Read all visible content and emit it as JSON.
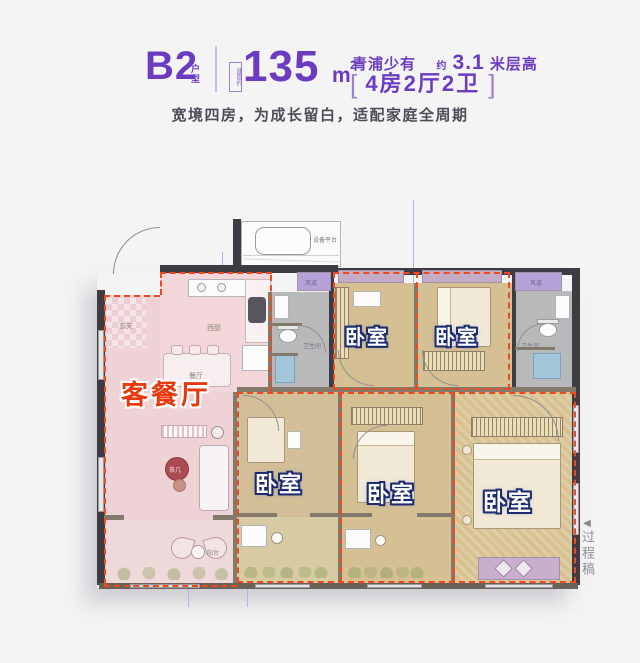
{
  "header": {
    "code": "B2",
    "code_suffix": "户型",
    "area_prefix": "建面约",
    "area_number": "135",
    "area_unit": "m",
    "area_sup": "2",
    "tagline_location": "青浦少有",
    "tagline_approx": "约",
    "tagline_height": "3.1",
    "tagline_height_unit": "米层高",
    "bracket_open": "[",
    "bracket_close": "]",
    "layout_spec": "4房2厅2卫",
    "subtitle": "宽境四房，为成长留白，适配家庭全周期",
    "accent_color": "#6b3cc0"
  },
  "plan": {
    "rooms": [
      {
        "name": "living-dining",
        "label": "客餐厅"
      },
      {
        "name": "bedroom-top-1",
        "label": "卧室"
      },
      {
        "name": "bedroom-top-2",
        "label": "卧室"
      },
      {
        "name": "bedroom-bottom-1",
        "label": "卧室"
      },
      {
        "name": "bedroom-bottom-2",
        "label": "卧室"
      },
      {
        "name": "bedroom-master",
        "label": "卧室"
      }
    ],
    "annotations": {
      "equipment_platform": "设备平台",
      "entry": "玄关",
      "west_kitchen": "西厨",
      "dining": "餐厅",
      "tea_table": "茶几",
      "balcony": "阳台",
      "bathroom": "卫生间",
      "duct": "风道"
    },
    "colors": {
      "living_floor": "#efd2d6",
      "bedroom_floor": "#d5c094",
      "bath_floor": "#b8b9bb",
      "bay_window": "#c4abc6",
      "duct_room": "#b5a2d9",
      "wall": "#3d3c43",
      "zone_outline": "#f1491f",
      "living_label": "#e8380e",
      "bedroom_label_outline": "#1c2c6e"
    }
  },
  "watermark": {
    "arrow": "◀",
    "text": "过程稿"
  }
}
